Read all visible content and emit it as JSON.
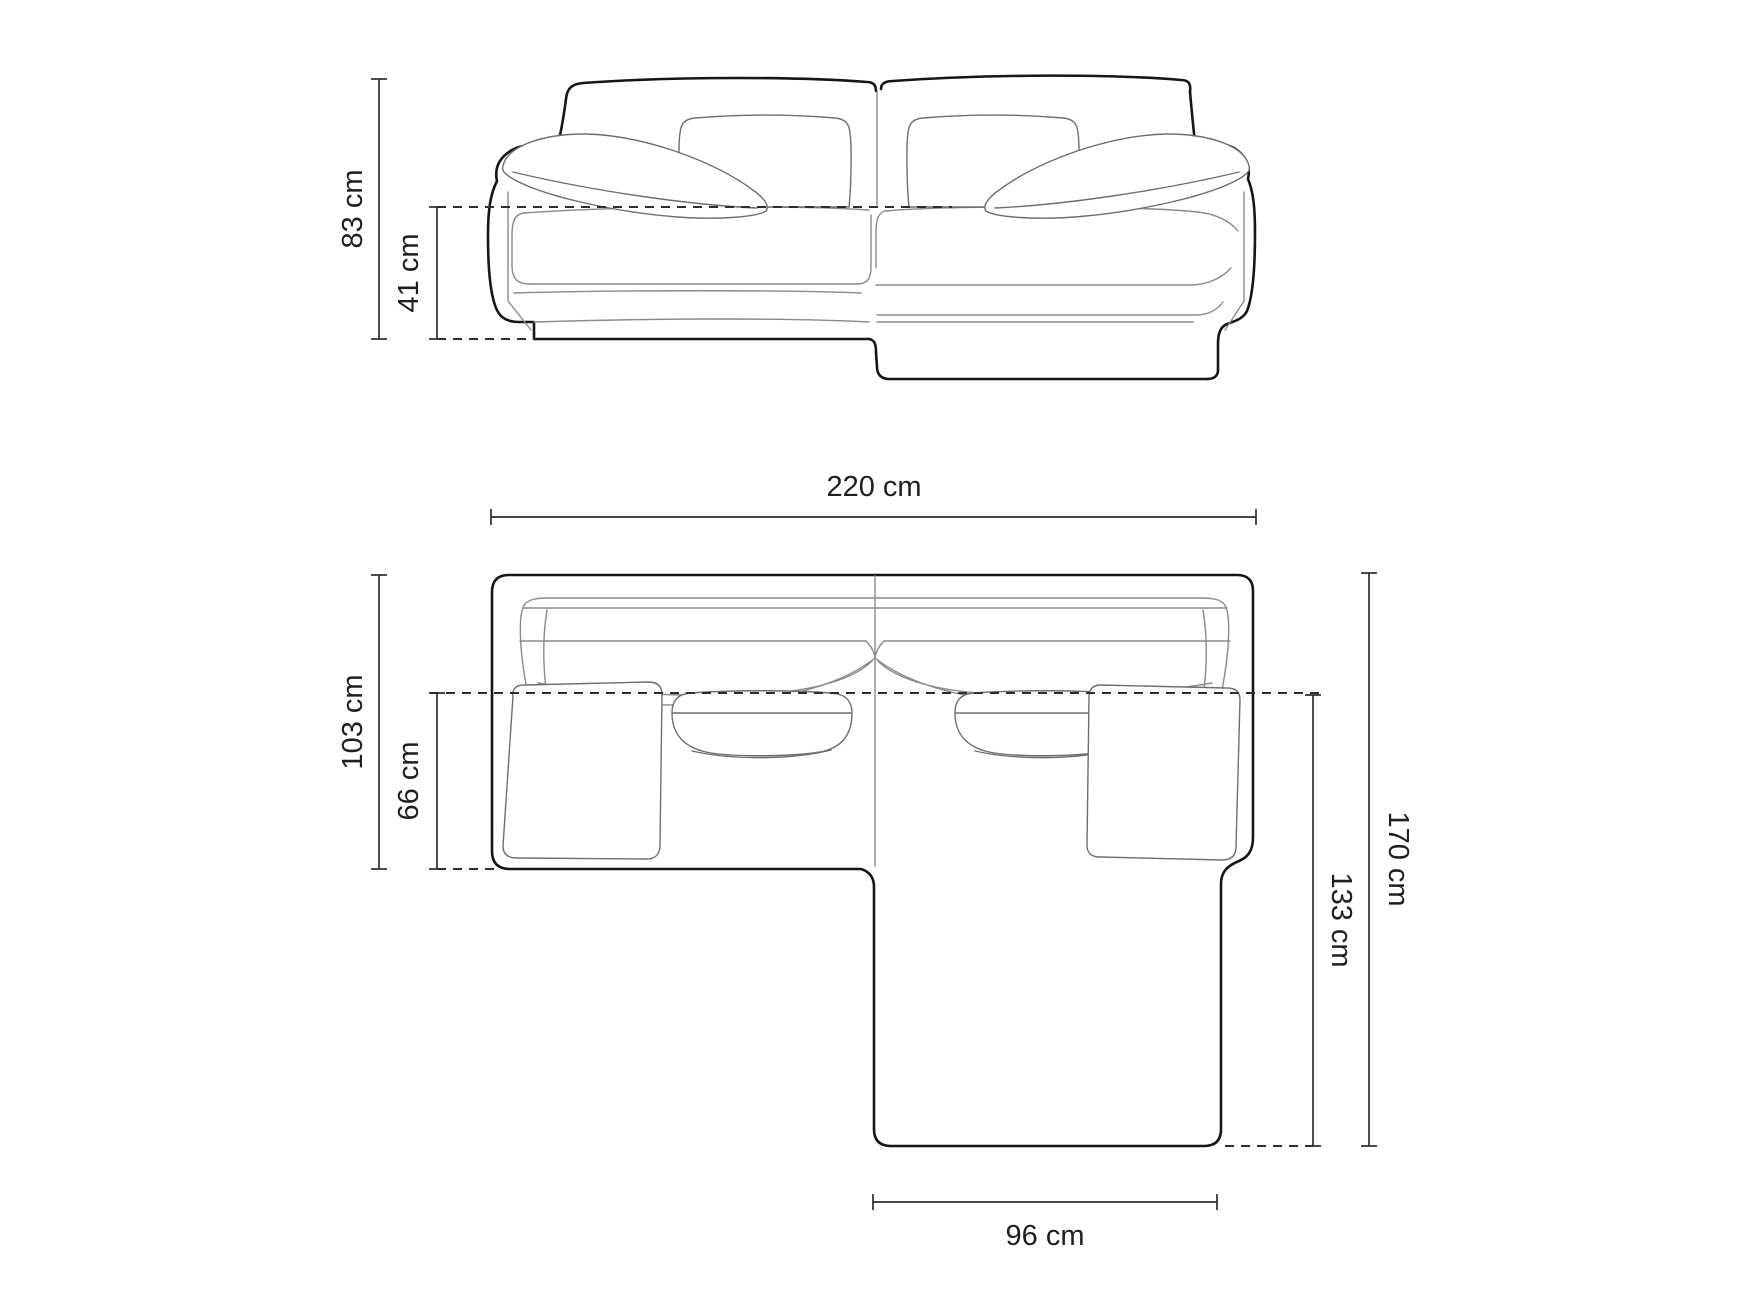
{
  "diagram": {
    "subject": "corner-sofa-dimension-drawing",
    "colors": {
      "background": "#ffffff",
      "outline": "#161616",
      "detail_lines": "#8a8a8a",
      "dimension_lines": "#2d2d2d",
      "label_text": "#1f1f1f"
    },
    "front_view": {
      "name": "front-elevation",
      "dimensions": {
        "total_height": {
          "label": "83 cm",
          "orientation": "vertical"
        },
        "seat_height": {
          "label": "41 cm",
          "orientation": "vertical"
        }
      }
    },
    "top_view": {
      "name": "plan-view",
      "dimensions": {
        "total_width": {
          "label": "220 cm",
          "orientation": "horizontal"
        },
        "body_depth": {
          "label": "103 cm",
          "orientation": "vertical"
        },
        "seat_depth": {
          "label": "66 cm",
          "orientation": "vertical"
        },
        "total_depth": {
          "label": "170 cm",
          "orientation": "vertical"
        },
        "chaise_depth": {
          "label": "133 cm",
          "orientation": "vertical"
        },
        "chaise_width": {
          "label": "96 cm",
          "orientation": "horizontal"
        }
      }
    }
  }
}
